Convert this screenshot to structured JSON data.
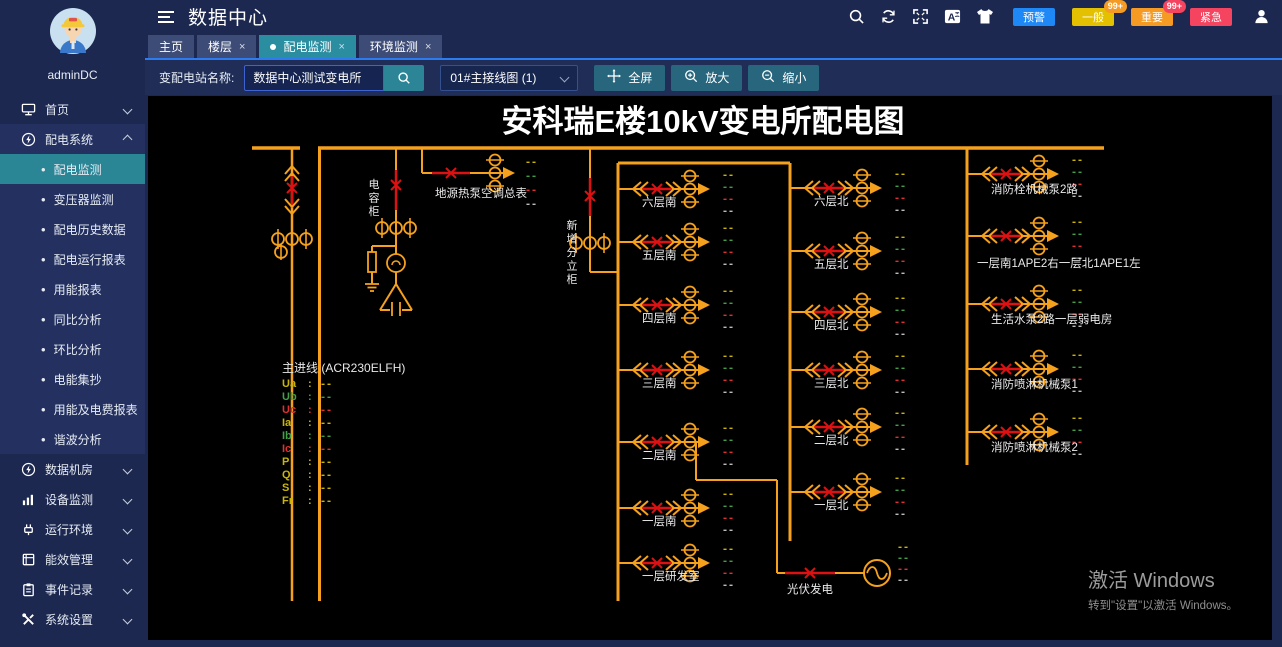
{
  "sidebar": {
    "username": "adminDC",
    "items": [
      {
        "key": "home",
        "label": "首页",
        "icon": "home-icon",
        "expanded": false
      },
      {
        "key": "power-system",
        "label": "配电系统",
        "icon": "power-icon",
        "expanded": true,
        "children": [
          {
            "key": "power-monitor",
            "label": "配电监测",
            "active": true
          },
          {
            "key": "transformer-monitor",
            "label": "变压器监测"
          },
          {
            "key": "power-history",
            "label": "配电历史数据"
          },
          {
            "key": "power-run-report",
            "label": "配电运行报表"
          },
          {
            "key": "energy-report",
            "label": "用能报表"
          },
          {
            "key": "yoy-analysis",
            "label": "同比分析"
          },
          {
            "key": "mom-analysis",
            "label": "环比分析"
          },
          {
            "key": "meter-reading",
            "label": "电能集抄"
          },
          {
            "key": "energy-fee-report",
            "label": "用能及电费报表"
          },
          {
            "key": "harmonic-analysis",
            "label": "谐波分析"
          }
        ]
      },
      {
        "key": "data-room",
        "label": "数据机房",
        "icon": "data-room-icon",
        "expanded": false
      },
      {
        "key": "device-monitor",
        "label": "设备监测",
        "icon": "device-icon",
        "expanded": false
      },
      {
        "key": "runtime-env",
        "label": "运行环境",
        "icon": "env-icon",
        "expanded": false
      },
      {
        "key": "energy-mgmt",
        "label": "能效管理",
        "icon": "energy-icon",
        "expanded": false
      },
      {
        "key": "event-log",
        "label": "事件记录",
        "icon": "event-icon",
        "expanded": false
      },
      {
        "key": "system-settings",
        "label": "系统设置",
        "icon": "settings-icon",
        "expanded": false
      }
    ]
  },
  "header": {
    "title": "数据中心",
    "tools": [
      {
        "name": "search-icon"
      },
      {
        "name": "refresh-icon"
      },
      {
        "name": "fullscreen-icon"
      },
      {
        "name": "translate-icon"
      },
      {
        "name": "theme-icon"
      }
    ],
    "badges": [
      {
        "key": "warning",
        "label": "预警",
        "color": "#1e88f7"
      },
      {
        "key": "normal",
        "label": "一般",
        "color": "#e3c000",
        "count": "99+",
        "count_color": "#f59a23"
      },
      {
        "key": "important",
        "label": "重要",
        "color": "#f59a23",
        "count": "99+",
        "count_color": "#f5445f"
      },
      {
        "key": "urgent",
        "label": "紧急",
        "color": "#f5445f"
      }
    ],
    "user_icon": "user-icon"
  },
  "tabs": [
    {
      "key": "home",
      "label": "主页",
      "closable": false,
      "active": false
    },
    {
      "key": "floor",
      "label": "楼层",
      "closable": true,
      "active": false
    },
    {
      "key": "power-monitor",
      "label": "配电监测",
      "closable": true,
      "active": true,
      "dot": true
    },
    {
      "key": "env-monitor",
      "label": "环境监测",
      "closable": true,
      "active": false
    }
  ],
  "toolbar": {
    "station_label": "变配电站名称:",
    "station_value": "数据中心测试变电所",
    "diagram_option": "01#主接线图 (1)",
    "buttons": [
      {
        "key": "fullscreen",
        "label": "全屏",
        "icon": "move-icon"
      },
      {
        "key": "zoom-in",
        "label": "放大",
        "icon": "zoom-in-icon"
      },
      {
        "key": "zoom-out",
        "label": "缩小",
        "icon": "zoom-out-icon"
      }
    ]
  },
  "diagram": {
    "title": "安科瑞E楼10kV变电所配电图",
    "placeholder": "--",
    "line_color": "#f5a11d",
    "breaker_color": "#dd1111",
    "label_color": "#eaeaea",
    "value_colors": [
      "#c9b509",
      "#43a047",
      "#e03030",
      "#bdbdbd"
    ],
    "labels": {
      "capacitor_cabinet": "电容柜",
      "new_cabinet": "新增分立柜",
      "ground_source_pump": "地源热泵空调总表",
      "pv": "光伏发电"
    },
    "main_panel": {
      "title": "主进线 (ACR230ELFH)",
      "rows": [
        {
          "name": "Ua",
          "color": "#c9b509"
        },
        {
          "name": "Ub",
          "color": "#43a047"
        },
        {
          "name": "Uc",
          "color": "#e03030"
        },
        {
          "name": "Ia",
          "color": "#c9b509"
        },
        {
          "name": "Ib",
          "color": "#43a047"
        },
        {
          "name": "Ic",
          "color": "#e03030"
        },
        {
          "name": "P",
          "color": "#c9b509"
        },
        {
          "name": "Q",
          "color": "#c9b509"
        },
        {
          "name": "S",
          "color": "#c9b509"
        },
        {
          "name": "Fr",
          "color": "#c9b509"
        }
      ]
    },
    "south_feeders": [
      "六层南",
      "五层南",
      "四层南",
      "三层南",
      "二层南",
      "一层南",
      "一层研发室"
    ],
    "north_feeders": [
      "六层北",
      "五层北",
      "四层北",
      "三层北",
      "二层北",
      "一层北"
    ],
    "right_feeders": [
      "消防栓机械泵2路",
      "一层南1APE2右一层北1APE1左",
      "生活水泵2路一层弱电房",
      "消防喷淋机械泵1",
      "消防喷淋机械泵2"
    ]
  },
  "watermark": {
    "line1": "激活 Windows",
    "line2": "转到\"设置\"以激活 Windows。"
  }
}
